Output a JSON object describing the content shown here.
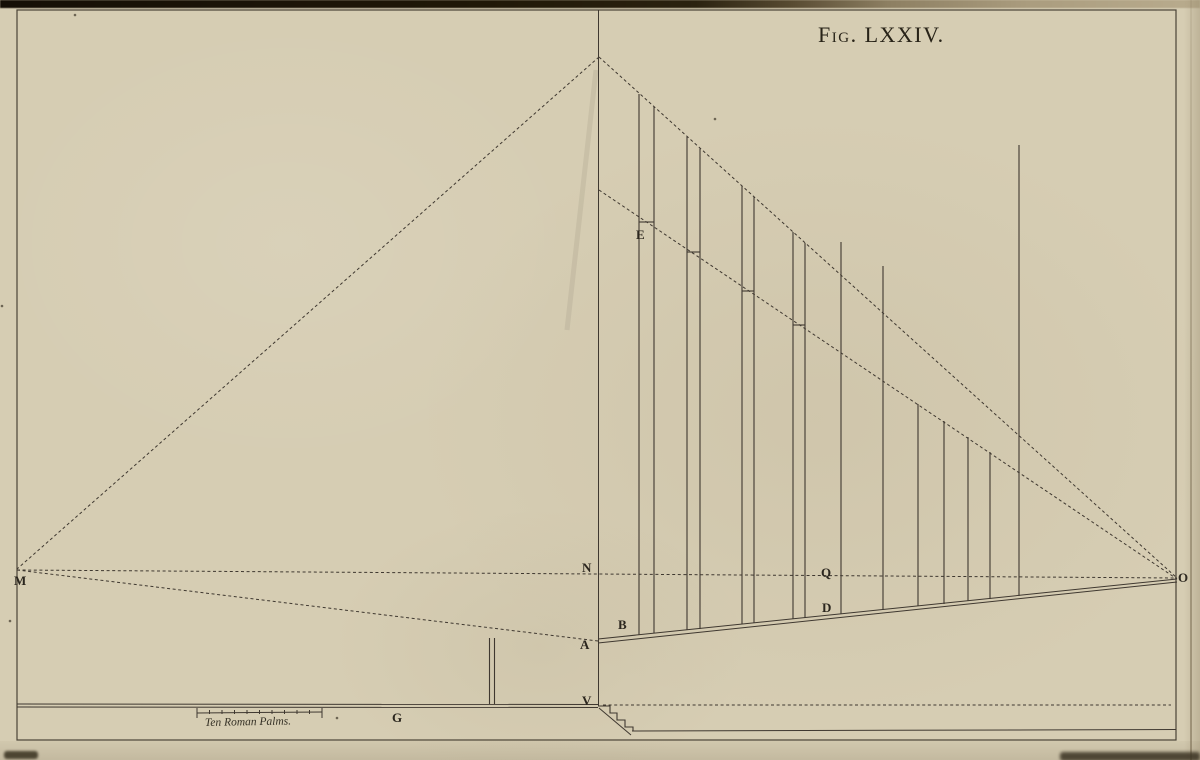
{
  "figure": {
    "plate_title": "Fig. LXXIV.",
    "background_color": "#d6cdb3",
    "stroke_color": "#3f3830",
    "label_color": "#2b261e",
    "border": {
      "x": 17,
      "y": 10,
      "w": 1159,
      "h": 730
    },
    "labels": [
      {
        "name": "M",
        "x": 14,
        "y": 585
      },
      {
        "name": "N",
        "x": 582,
        "y": 572
      },
      {
        "name": "Q",
        "x": 821,
        "y": 577
      },
      {
        "name": "O",
        "x": 1178,
        "y": 582
      },
      {
        "name": "E",
        "x": 636,
        "y": 239
      },
      {
        "name": "B",
        "x": 618,
        "y": 629
      },
      {
        "name": "D",
        "x": 822,
        "y": 612
      },
      {
        "name": "A",
        "x": 580,
        "y": 649
      },
      {
        "name": "V",
        "x": 582,
        "y": 705
      },
      {
        "name": "G",
        "x": 392,
        "y": 722
      }
    ],
    "solid_lines": [
      {
        "name": "main-vertical",
        "x1": 598.5,
        "y1": 10,
        "x2": 598.5,
        "y2": 706
      },
      {
        "name": "base-rail-top",
        "x1": 598,
        "y1": 639,
        "x2": 1177,
        "y2": 579
      },
      {
        "name": "base-rail-bottom",
        "x1": 598,
        "y1": 643,
        "x2": 1177,
        "y2": 582
      },
      {
        "name": "ground-left-top",
        "x1": 17,
        "y1": 704,
        "x2": 598,
        "y2": 704.5
      },
      {
        "name": "ground-left-bottom",
        "x1": 17,
        "y1": 707,
        "x2": 598,
        "y2": 707.5
      },
      {
        "name": "ground-right-lower",
        "x1": 632,
        "y1": 731,
        "x2": 1176,
        "y2": 729.5
      },
      {
        "name": "stair-diagonal",
        "x1": 599,
        "y1": 708,
        "x2": 631,
        "y2": 735
      }
    ],
    "dashed_lines": [
      {
        "name": "apex-to-M",
        "x1": 599,
        "y1": 57,
        "x2": 17,
        "y2": 569
      },
      {
        "name": "apex-to-O",
        "x1": 599,
        "y1": 57,
        "x2": 1177,
        "y2": 578
      },
      {
        "name": "e-line-to-O",
        "x1": 599,
        "y1": 190,
        "x2": 1177,
        "y2": 579
      },
      {
        "name": "horizon-M-N-Q-O",
        "x1": 17,
        "y1": 570,
        "x2": 1177,
        "y2": 578
      },
      {
        "name": "M-to-A",
        "x1": 17,
        "y1": 570,
        "x2": 598,
        "y2": 641
      },
      {
        "name": "ground-level-dashed",
        "x1": 603,
        "y1": 705,
        "x2": 1171,
        "y2": 705
      }
    ],
    "stairs_path": "M 598 706 L 610 706 L 610 713 L 617 713 L 617 720 L 625 720 L 625 727 L 633 727 L 633 731",
    "posts": [
      {
        "name": "post-1-left",
        "x": 639,
        "top": 94,
        "base": 635
      },
      {
        "name": "post-1-right",
        "x": 654,
        "top": 107,
        "base": 633
      },
      {
        "name": "post-2-left",
        "x": 687,
        "top": 137,
        "base": 630
      },
      {
        "name": "post-2-right",
        "x": 700,
        "top": 148.5,
        "base": 629
      },
      {
        "name": "post-3-left",
        "x": 742,
        "top": 186,
        "base": 624
      },
      {
        "name": "post-3-right",
        "x": 754,
        "top": 197,
        "base": 623
      },
      {
        "name": "post-4-left",
        "x": 793,
        "top": 232,
        "base": 619
      },
      {
        "name": "post-4-right",
        "x": 805,
        "top": 243,
        "base": 618
      },
      {
        "name": "post-5",
        "x": 841,
        "top": 242,
        "base": 614
      },
      {
        "name": "post-6",
        "x": 883,
        "top": 266,
        "base": 610
      },
      {
        "name": "post-7",
        "x": 918,
        "top": 404,
        "base": 606
      },
      {
        "name": "post-8",
        "x": 944,
        "top": 421,
        "base": 604
      },
      {
        "name": "post-9",
        "x": 968,
        "top": 437,
        "base": 601
      },
      {
        "name": "post-10",
        "x": 990,
        "top": 452,
        "base": 599
      },
      {
        "name": "post-11-tall",
        "x": 1019,
        "top": 145,
        "base": 596
      },
      {
        "name": "marker-post-left",
        "x": 489.5,
        "top": 638,
        "base": 704
      },
      {
        "name": "marker-post-right",
        "x": 494.5,
        "top": 638,
        "base": 704
      }
    ],
    "crossbars": [
      {
        "name": "crossbar-1",
        "x1": 639,
        "x2": 654,
        "y": 222
      },
      {
        "name": "crossbar-2",
        "x1": 687,
        "x2": 700,
        "y": 252
      },
      {
        "name": "crossbar-3",
        "x1": 742,
        "x2": 754,
        "y": 291
      },
      {
        "name": "crossbar-4",
        "x1": 793,
        "x2": 805,
        "y": 325
      }
    ],
    "scale_bar": {
      "x1": 197,
      "x2": 322,
      "y": 713,
      "divisions": 10,
      "label": "Ten Roman Palms."
    },
    "specks": [
      {
        "x": 10,
        "y": 621
      },
      {
        "x": 2,
        "y": 306
      },
      {
        "x": 337,
        "y": 718
      },
      {
        "x": 75,
        "y": 15
      },
      {
        "x": 715,
        "y": 119
      }
    ],
    "artifact_streak": {
      "x1": 596,
      "y1": 70,
      "x2": 567,
      "y2": 330
    }
  }
}
